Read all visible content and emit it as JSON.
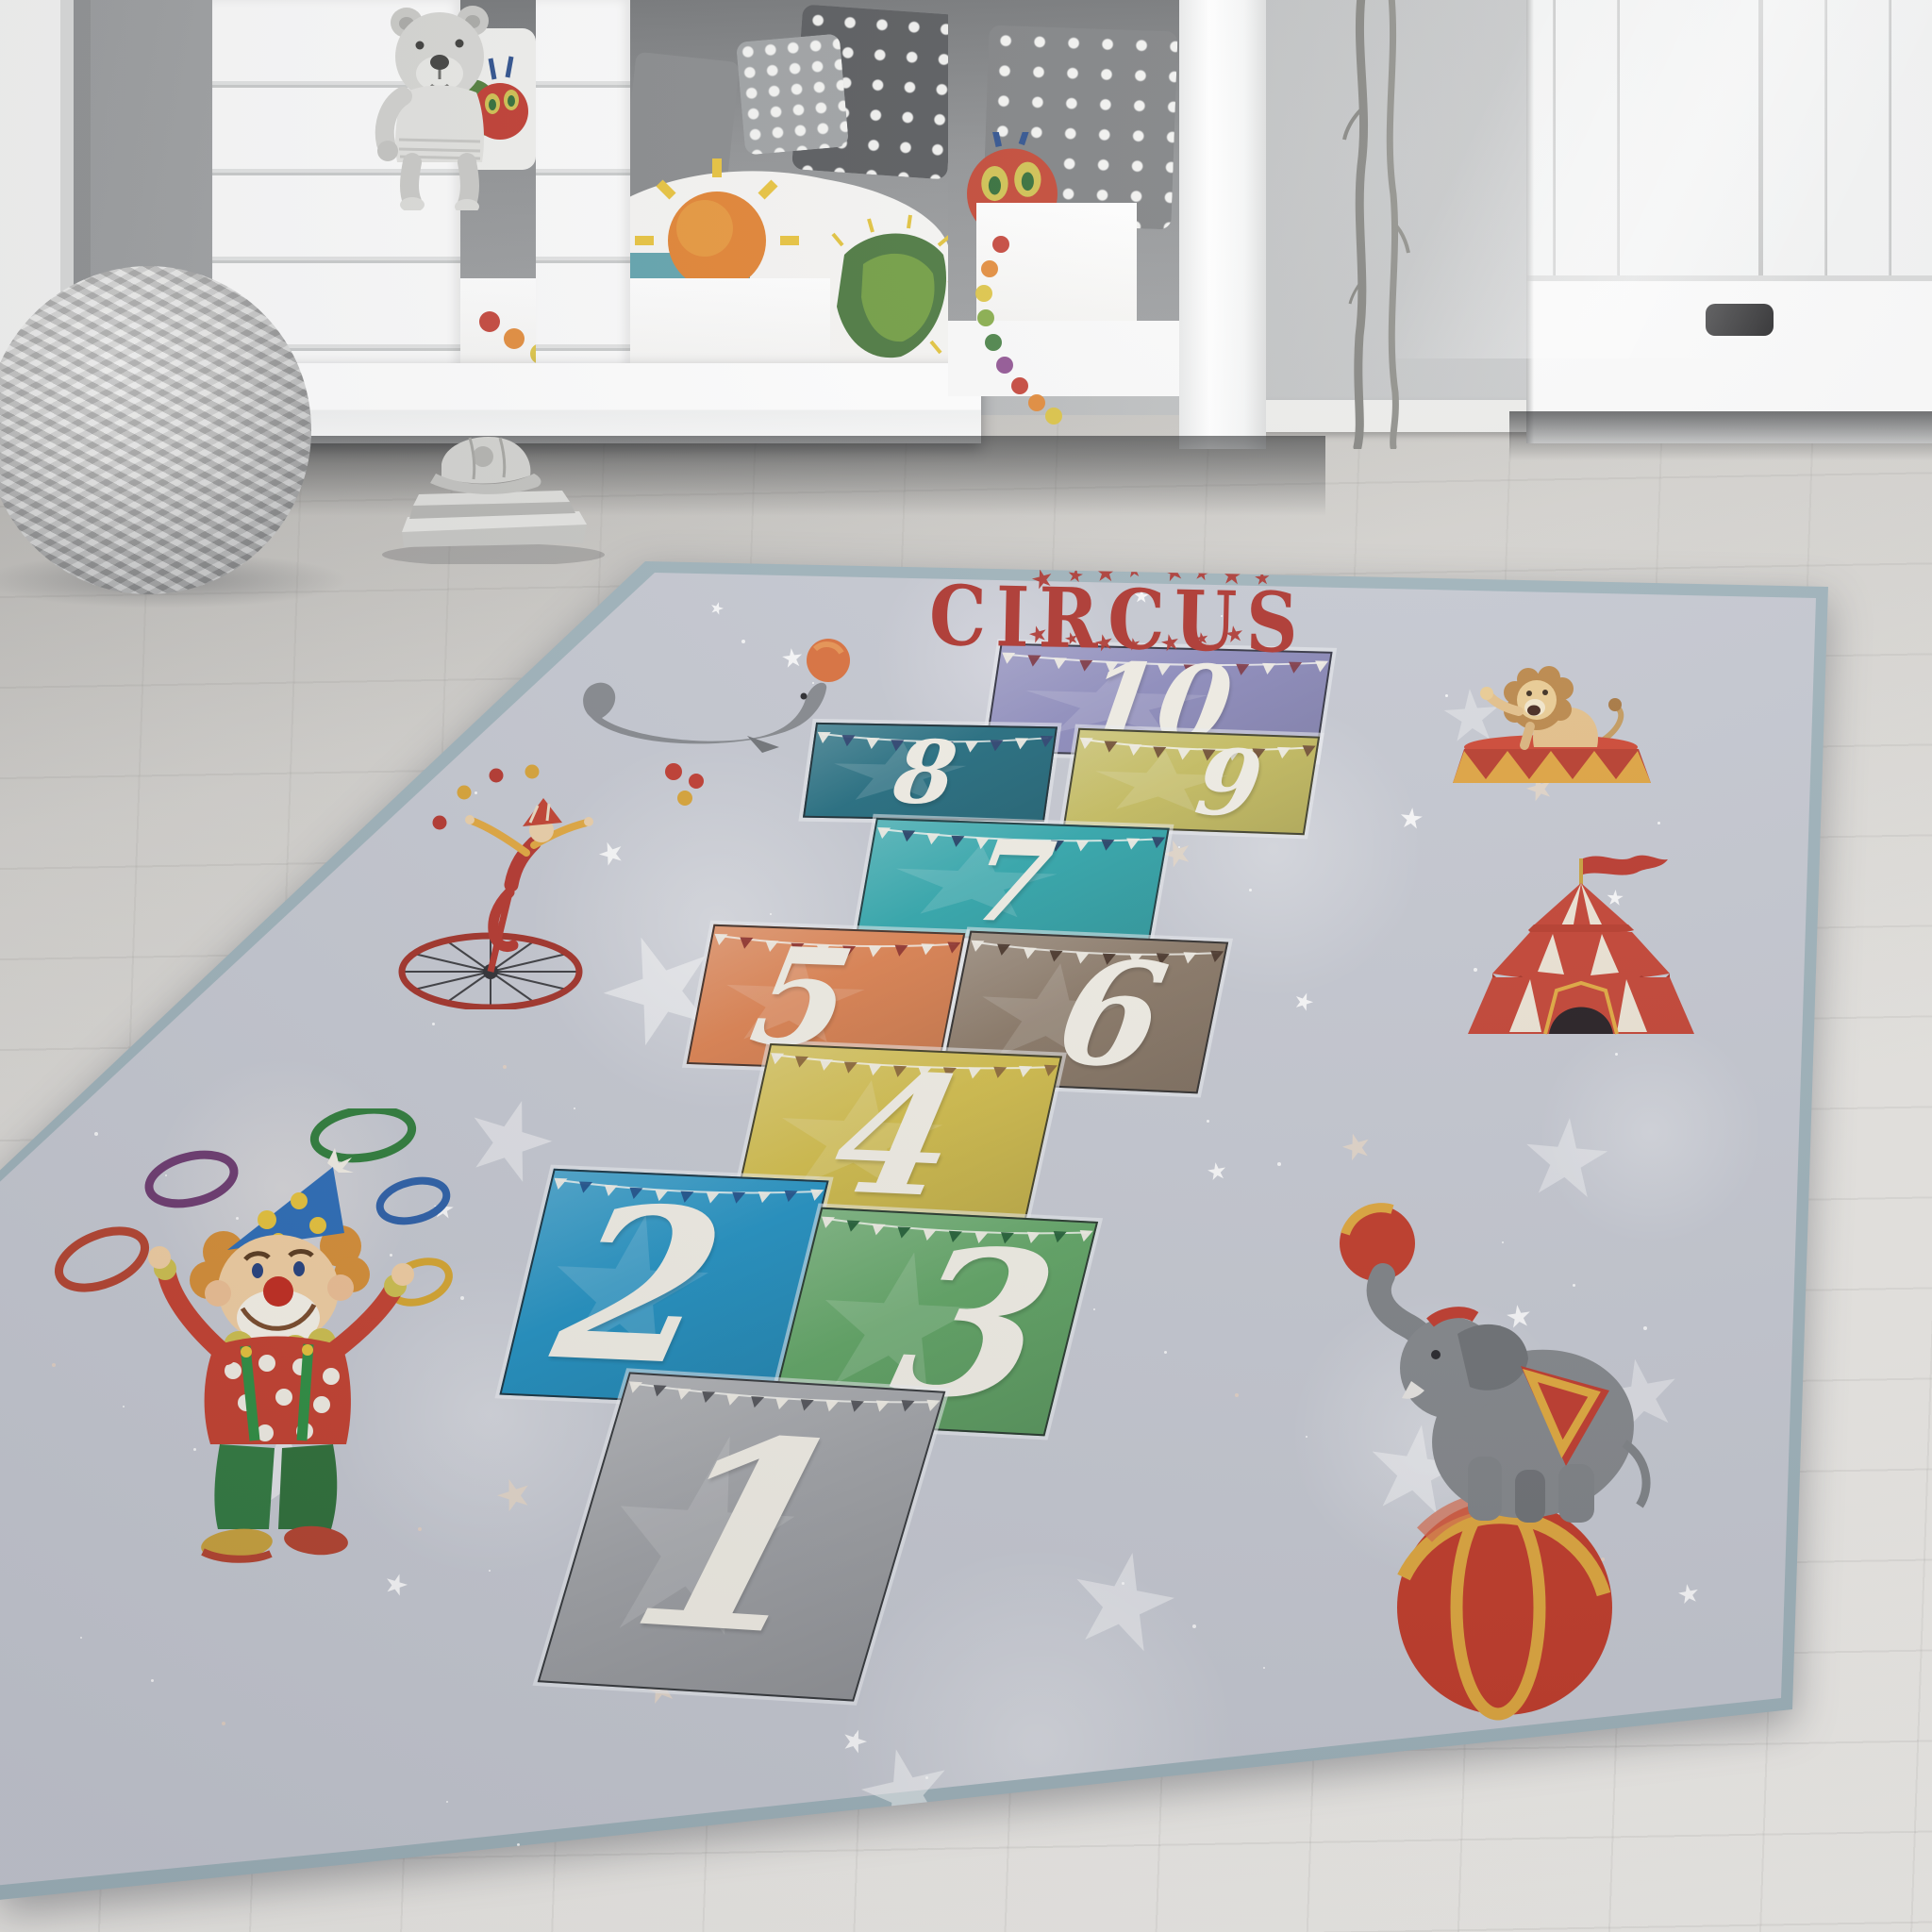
{
  "room": {
    "wall_color": "#aeb0b1",
    "floor_color": "#e7e5e1",
    "mattress_color": "#5fa2ac",
    "objects": [
      "window-frame",
      "house-frame-bed",
      "teddy-bear",
      "polka-dot-pillows",
      "caterpillar-pillow",
      "caterpillar-print-duvet",
      "sun-print-duvet",
      "knitted-pouf",
      "book-stack-with-cap",
      "decorative-branches",
      "white-wardrobe",
      "wood-floor"
    ]
  },
  "rug": {
    "title": "CIRCUS",
    "title_color": "#ae332c",
    "base_color": "#c6c9d2",
    "edge_color": "#9fb3bb",
    "number_color": "#f2efe6",
    "star_color": "#ffffff",
    "squares": [
      {
        "number": "10",
        "color": "#8c8abc",
        "flag_accent": "#7c3340"
      },
      {
        "number": "8",
        "color": "#206b7e",
        "flag_accent": "#2a3f6e"
      },
      {
        "number": "9",
        "color": "#c6bd5e",
        "flag_accent": "#6e4a2f"
      },
      {
        "number": "7",
        "color": "#2fa7ac",
        "flag_accent": "#223c63"
      },
      {
        "number": "5",
        "color": "#de8250",
        "flag_accent": "#8e2f2a"
      },
      {
        "number": "6",
        "color": "#8a7866",
        "flag_accent": "#463226"
      },
      {
        "number": "4",
        "color": "#d2bd4a",
        "flag_accent": "#8a6436"
      },
      {
        "number": "2",
        "color": "#2191c2",
        "flag_accent": "#1d4f8a"
      },
      {
        "number": "3",
        "color": "#5fa463",
        "flag_accent": "#1f5c33"
      },
      {
        "number": "1",
        "color": "#a0a2a6",
        "flag_accent": "#4e4f54"
      }
    ],
    "illustrations": [
      "seal-with-ball",
      "juggler-on-unicycle",
      "clown-with-rings",
      "lion-on-podium",
      "circus-tent",
      "elephant-on-ball"
    ]
  }
}
